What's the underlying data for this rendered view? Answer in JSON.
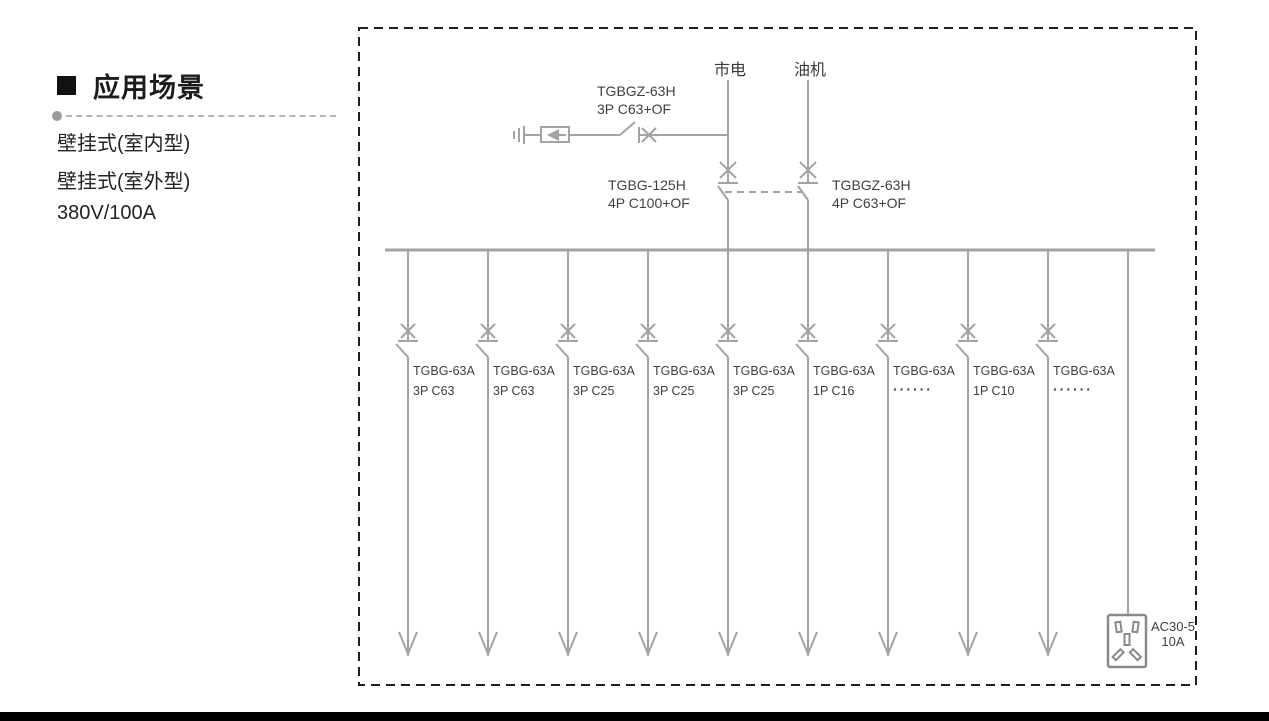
{
  "left_panel": {
    "bullet": "■",
    "title": "应用场景",
    "items": [
      "壁挂式(室内型)",
      "壁挂式(室外型)",
      "380V/100A"
    ]
  },
  "diagram": {
    "mains_label": "市电",
    "generator_label": "油机",
    "spd_breaker": {
      "model": "TGBGZ-63H",
      "spec": "3P C63+OF"
    },
    "mains_breaker": {
      "model": "TGBG-125H",
      "spec": "4P C100+OF"
    },
    "generator_breaker": {
      "model": "TGBGZ-63H",
      "spec": "4P C63+OF"
    },
    "branches": [
      {
        "model": "TGBG-63A",
        "spec": "3P C63"
      },
      {
        "model": "TGBG-63A",
        "spec": "3P C63"
      },
      {
        "model": "TGBG-63A",
        "spec": "3P C25"
      },
      {
        "model": "TGBG-63A",
        "spec": "3P C25"
      },
      {
        "model": "TGBG-63A",
        "spec": "3P C25"
      },
      {
        "model": "TGBG-63A",
        "spec": "1P C16"
      },
      {
        "model": "TGBG-63A",
        "spec": "······"
      },
      {
        "model": "TGBG-63A",
        "spec": "1P C10"
      },
      {
        "model": "TGBG-63A",
        "spec": "······"
      }
    ],
    "socket": {
      "model": "AC30-5",
      "rating": "10A"
    }
  },
  "colors": {
    "line": "#a3a3a3",
    "label_text": "#414141",
    "heading_text": "#1c1c1c",
    "border": "#1f1f1f",
    "bottom_bar": "#000000"
  }
}
